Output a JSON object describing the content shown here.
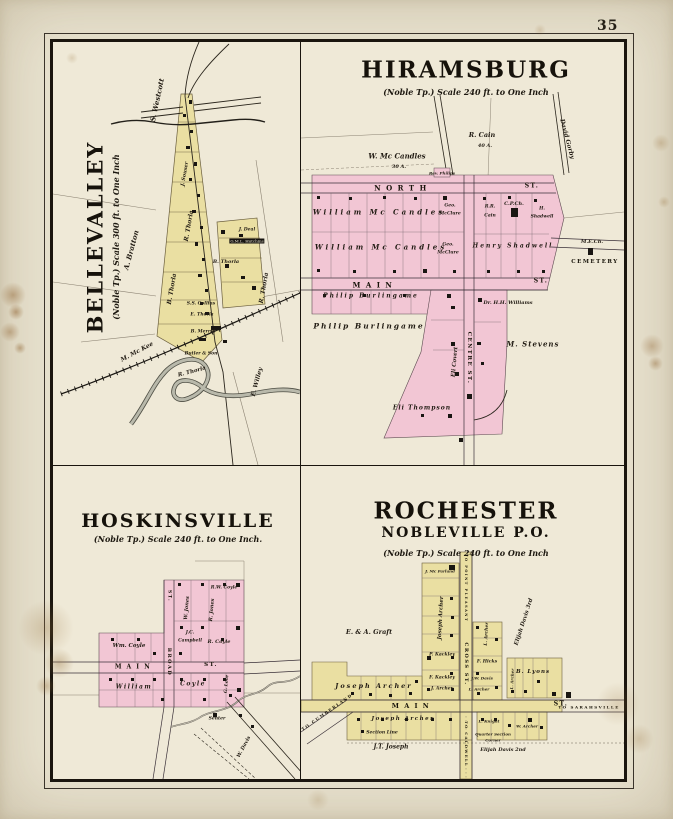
{
  "page": {
    "number": "35"
  },
  "colors": {
    "paper": "#e9e3d0",
    "panel_paper": "#efe9d7",
    "town_pink": "#f2c6d4",
    "town_yellow": "#eadfa2",
    "ink": "#221c14",
    "frame": "#1a150e"
  },
  "bellevalley": {
    "title": "BELLEVALLEY",
    "subtitle": "(Noble Tp.) Scale 300 ft. to One Inch",
    "labels": [
      {
        "t": "S. Westcott",
        "x": 104,
        "y": 58,
        "r": -78,
        "s": 7
      },
      {
        "t": "A. Bratton",
        "x": 78,
        "y": 208,
        "r": -75,
        "s": 7
      },
      {
        "t": "J. Souser",
        "x": 132,
        "y": 132,
        "r": -80,
        "s": 5
      },
      {
        "t": "R. Thorla",
        "x": 136,
        "y": 184,
        "r": -80,
        "s": 6
      },
      {
        "t": "B. Thorla",
        "x": 119,
        "y": 247,
        "r": -80,
        "s": 6
      },
      {
        "t": "S.S. Collins",
        "x": 148,
        "y": 262,
        "s": 4.5
      },
      {
        "t": "E. Thorla",
        "x": 149,
        "y": 273,
        "s": 4.5
      },
      {
        "t": "B. Merrill",
        "x": 150,
        "y": 290,
        "s": 4.5
      },
      {
        "t": "Butler & Son",
        "x": 148,
        "y": 312,
        "s": 4.5
      },
      {
        "t": "J. Deal",
        "x": 194,
        "y": 188,
        "s": 4.5
      },
      {
        "t": "G.M.L. Hutchins",
        "x": 194,
        "y": 199,
        "s": 4,
        "k": "box"
      },
      {
        "t": "B. Thorla",
        "x": 173,
        "y": 220,
        "s": 5
      },
      {
        "t": "R. Thorla",
        "x": 211,
        "y": 246,
        "r": -80,
        "s": 6
      },
      {
        "t": "M. Mc Kee",
        "x": 84,
        "y": 310,
        "r": -28,
        "s": 6
      },
      {
        "t": "E. Willey",
        "x": 204,
        "y": 340,
        "r": -75,
        "s": 6
      },
      {
        "t": "R. Thorla",
        "x": 139,
        "y": 330,
        "r": -15,
        "s": 5.5
      }
    ]
  },
  "hiramsburg": {
    "title": "HIRAMSBURG",
    "subtitle": "(Noble Tp.)  Scale 240 ft. to One Inch",
    "labels": [
      {
        "t": "W. Mc Candles",
        "x": 96,
        "y": 114,
        "s": 7
      },
      {
        "t": "30 A.",
        "x": 98,
        "y": 125,
        "s": 5
      },
      {
        "t": "R. Cain",
        "x": 181,
        "y": 93,
        "s": 6.5
      },
      {
        "t": "40 A.",
        "x": 184,
        "y": 104,
        "s": 5
      },
      {
        "t": "David Gorby",
        "x": 266,
        "y": 97,
        "r": 75,
        "s": 6
      },
      {
        "t": "Rev. Philips",
        "x": 141,
        "y": 131,
        "s": 4
      },
      {
        "t": "N O R T H",
        "x": 100,
        "y": 146,
        "s": 7,
        "k": "street"
      },
      {
        "t": "ST.",
        "x": 231,
        "y": 144,
        "s": 6,
        "k": "street"
      },
      {
        "t": "William Mc Candles",
        "x": 78,
        "y": 170,
        "s": 7,
        "sp": 3
      },
      {
        "t": "William Mc Candles",
        "x": 80,
        "y": 205,
        "s": 7,
        "sp": 3
      },
      {
        "t": "Geo.",
        "x": 149,
        "y": 164,
        "s": 4.5
      },
      {
        "t": "McClure",
        "x": 149,
        "y": 172,
        "s": 4.5
      },
      {
        "t": "Geo.",
        "x": 147,
        "y": 203,
        "s": 4.5
      },
      {
        "t": "McClure",
        "x": 147,
        "y": 211,
        "s": 4.5
      },
      {
        "t": "R.R.",
        "x": 189,
        "y": 165,
        "s": 4.5
      },
      {
        "t": "Cain",
        "x": 189,
        "y": 174,
        "s": 4.5
      },
      {
        "t": "C.P.Ch.",
        "x": 213,
        "y": 162,
        "s": 5
      },
      {
        "t": "H.",
        "x": 241,
        "y": 167,
        "s": 4.5
      },
      {
        "t": "Shadwell",
        "x": 241,
        "y": 175,
        "s": 4.5
      },
      {
        "t": "Henry Shadwell",
        "x": 212,
        "y": 204,
        "s": 6,
        "sp": 2
      },
      {
        "t": "M A I N",
        "x": 72,
        "y": 243,
        "s": 7,
        "k": "street"
      },
      {
        "t": "ST.",
        "x": 240,
        "y": 239,
        "s": 6,
        "k": "street"
      },
      {
        "t": "Philip Burlingame",
        "x": 70,
        "y": 254,
        "s": 6,
        "sp": 2
      },
      {
        "t": "Philip Burlingame",
        "x": 68,
        "y": 284,
        "s": 7.5,
        "sp": 2
      },
      {
        "t": "Dr. H.H. Williams",
        "x": 207,
        "y": 261,
        "s": 5
      },
      {
        "t": "M. Stevens",
        "x": 232,
        "y": 302,
        "s": 7,
        "sp": 1
      },
      {
        "t": "Eli Covert",
        "x": 154,
        "y": 320,
        "r": -85,
        "s": 5.5
      },
      {
        "t": "CENTRE ST.",
        "x": 168,
        "y": 316,
        "r": 90,
        "s": 5.5,
        "k": "street"
      },
      {
        "t": "Eli Thompson",
        "x": 121,
        "y": 366,
        "s": 6,
        "sp": 1
      },
      {
        "t": "M.E.Ch.",
        "x": 291,
        "y": 200,
        "s": 5
      },
      {
        "t": "CEMETERY",
        "x": 294,
        "y": 220,
        "s": 5.5,
        "k": "street"
      }
    ]
  },
  "hoskinsville": {
    "title": "HOSKINSVILLE",
    "subtitle": "(Noble Tp.) Scale 240 ft. to One Inch.",
    "labels": [
      {
        "t": "R.W. Coyle",
        "x": 171,
        "y": 122,
        "s": 4.5
      },
      {
        "t": "ST.",
        "x": 116,
        "y": 130,
        "r": 90,
        "s": 4.5,
        "k": "street"
      },
      {
        "t": "W. Jones",
        "x": 134,
        "y": 142,
        "r": -85,
        "s": 5
      },
      {
        "t": "R. Jones",
        "x": 159,
        "y": 144,
        "r": -85,
        "s": 5
      },
      {
        "t": "J.C.",
        "x": 137,
        "y": 167,
        "s": 4.5
      },
      {
        "t": "Campbell",
        "x": 137,
        "y": 175,
        "s": 4.5
      },
      {
        "t": "R. Coyle",
        "x": 166,
        "y": 176,
        "s": 5
      },
      {
        "t": "Wm. Coyle",
        "x": 76,
        "y": 180,
        "s": 5.5
      },
      {
        "t": "M A I N",
        "x": 80,
        "y": 201,
        "s": 6,
        "k": "street"
      },
      {
        "t": "ST.",
        "x": 158,
        "y": 199,
        "s": 5.5,
        "k": "street"
      },
      {
        "t": "BROAD",
        "x": 116,
        "y": 196,
        "r": 90,
        "s": 5,
        "k": "street"
      },
      {
        "t": "William",
        "x": 81,
        "y": 221,
        "s": 6,
        "sp": 1.5
      },
      {
        "t": "Coyle",
        "x": 140,
        "y": 218,
        "s": 6,
        "sp": 1.5
      },
      {
        "t": "G. Love",
        "x": 174,
        "y": 218,
        "r": -85,
        "s": 4.5
      },
      {
        "t": "Senter",
        "x": 164,
        "y": 253,
        "s": 4.5
      },
      {
        "t": "W. Davis",
        "x": 191,
        "y": 281,
        "r": -62,
        "s": 5
      }
    ]
  },
  "rochester": {
    "title": "ROCHESTER",
    "subtitle2": "NOBLEVILLE P.O.",
    "subtitle": "(Noble Tp.)   Scale 240 ft. to One Inch",
    "labels": [
      {
        "t": "J. Mc Farland",
        "x": 139,
        "y": 105,
        "s": 4
      },
      {
        "t": "TO POINT PLEASANT",
        "x": 165,
        "y": 122,
        "r": 90,
        "s": 3.5,
        "k": "street"
      },
      {
        "t": "Joseph Archer",
        "x": 140,
        "y": 152,
        "r": -87,
        "s": 5.5
      },
      {
        "t": "E. & A. Graft",
        "x": 68,
        "y": 166,
        "s": 6.5
      },
      {
        "t": "P. Kackley",
        "x": 141,
        "y": 189,
        "s": 4.5
      },
      {
        "t": "L. Archer",
        "x": 186,
        "y": 168,
        "r": -87,
        "s": 4.5
      },
      {
        "t": "F. Hicks",
        "x": 186,
        "y": 196,
        "s": 4.5
      },
      {
        "t": "F. Kackley",
        "x": 141,
        "y": 212,
        "s": 4.5
      },
      {
        "t": "J. Archer",
        "x": 141,
        "y": 223,
        "s": 4.5
      },
      {
        "t": "J.W. Davis",
        "x": 181,
        "y": 212,
        "s": 4
      },
      {
        "t": "L. Archer",
        "x": 178,
        "y": 223,
        "s": 4
      },
      {
        "t": "Elijah Davis 3rd",
        "x": 223,
        "y": 156,
        "r": -72,
        "s": 5.5
      },
      {
        "t": "B. Lyons",
        "x": 232,
        "y": 206,
        "s": 5.5,
        "sp": 1
      },
      {
        "t": "L. Archer",
        "x": 211,
        "y": 213,
        "r": -87,
        "s": 4
      },
      {
        "t": "Joseph Archer",
        "x": 73,
        "y": 220,
        "s": 6.5,
        "sp": 2
      },
      {
        "t": "CROSS ST.",
        "x": 165,
        "y": 198,
        "r": 90,
        "s": 5,
        "k": "street"
      },
      {
        "t": "TO CUMBERLAND",
        "x": 26,
        "y": 246,
        "r": -35,
        "s": 4,
        "k": "street"
      },
      {
        "t": "M A I N",
        "x": 110,
        "y": 240,
        "s": 6.5,
        "k": "street"
      },
      {
        "t": "ST.",
        "x": 260,
        "y": 238,
        "s": 6,
        "k": "street"
      },
      {
        "t": "TO SARAHSVILLE",
        "x": 288,
        "y": 241,
        "s": 4,
        "k": "street"
      },
      {
        "t": "TO CALDWELL",
        "x": 165,
        "y": 278,
        "r": 90,
        "s": 3.5,
        "k": "street"
      },
      {
        "t": "Joseph Archer",
        "x": 102,
        "y": 253,
        "s": 5.5,
        "sp": 1.5
      },
      {
        "t": "Section Line",
        "x": 81,
        "y": 267,
        "s": 4.5
      },
      {
        "t": "J.T. Joseph",
        "x": 90,
        "y": 281,
        "s": 6
      },
      {
        "t": "L. Knight",
        "x": 188,
        "y": 255,
        "s": 4
      },
      {
        "t": "Quarter Section",
        "x": 192,
        "y": 268,
        "s": 4
      },
      {
        "t": "Corner",
        "x": 192,
        "y": 274,
        "s": 4
      },
      {
        "t": "Elijah Davis 2nd",
        "x": 202,
        "y": 284,
        "s": 5
      },
      {
        "t": "W. Archer",
        "x": 226,
        "y": 260,
        "s": 4
      }
    ]
  }
}
